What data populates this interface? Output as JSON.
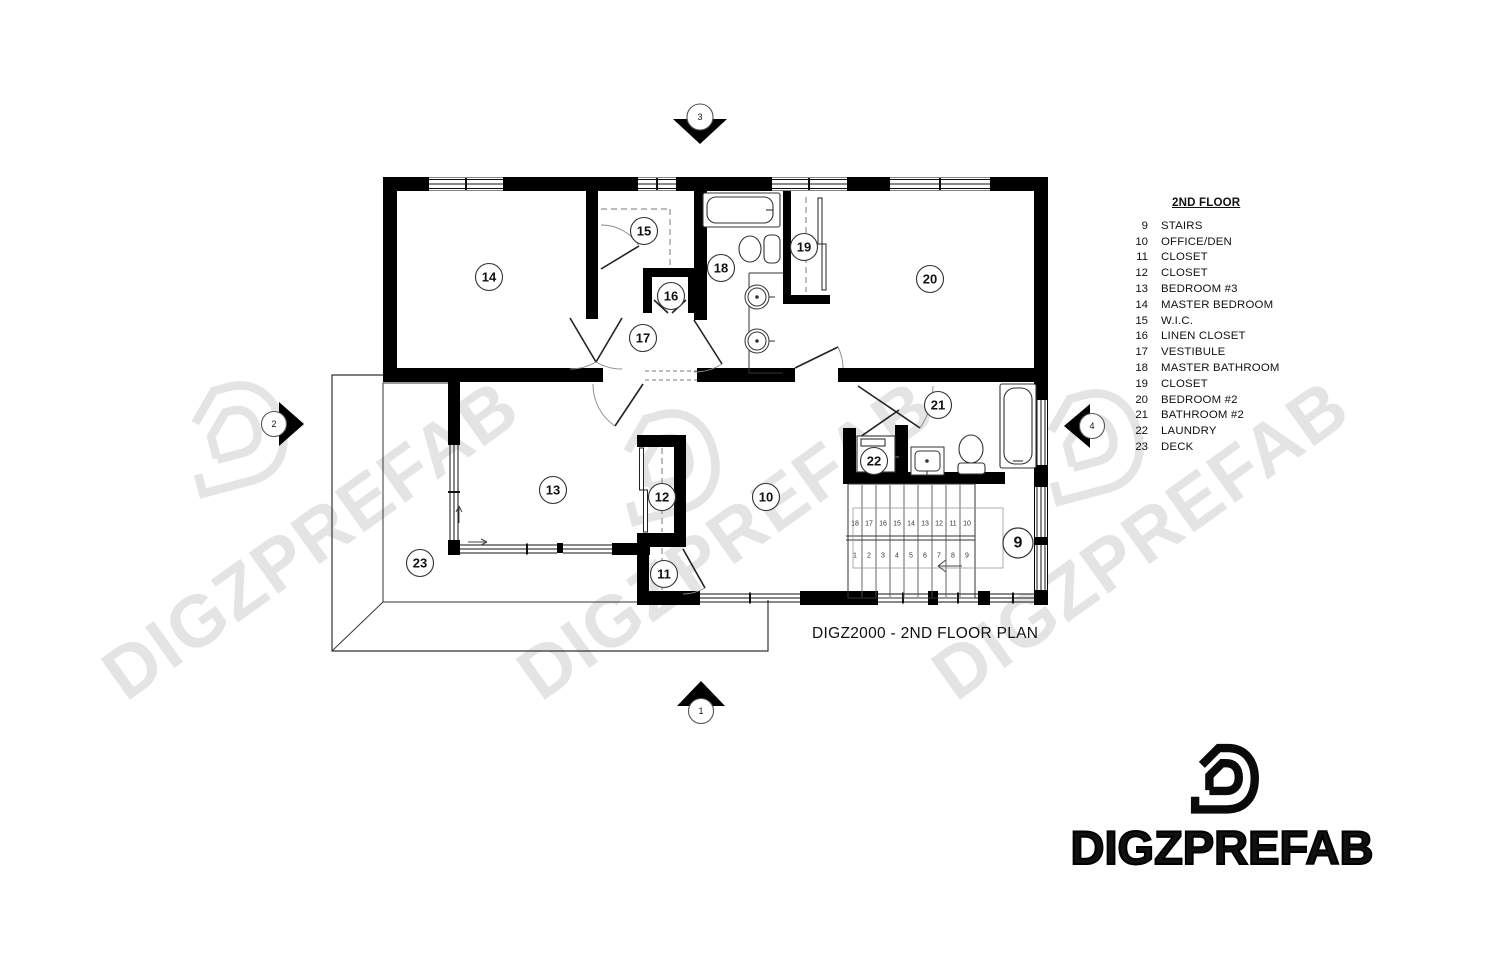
{
  "title": "DIGZ2000 - 2ND FLOOR PLAN",
  "legend": {
    "title": "2ND FLOOR",
    "items": [
      {
        "num": "9",
        "label": "STAIRS"
      },
      {
        "num": "10",
        "label": "OFFICE/DEN"
      },
      {
        "num": "11",
        "label": "CLOSET"
      },
      {
        "num": "12",
        "label": "CLOSET"
      },
      {
        "num": "13",
        "label": "BEDROOM #3"
      },
      {
        "num": "14",
        "label": "MASTER BEDROOM"
      },
      {
        "num": "15",
        "label": "W.I.C."
      },
      {
        "num": "16",
        "label": "LINEN CLOSET"
      },
      {
        "num": "17",
        "label": "VESTIBULE"
      },
      {
        "num": "18",
        "label": "MASTER BATHROOM"
      },
      {
        "num": "19",
        "label": "CLOSET"
      },
      {
        "num": "20",
        "label": "BEDROOM #2"
      },
      {
        "num": "21",
        "label": "BATHROOM #2"
      },
      {
        "num": "22",
        "label": "LAUNDRY"
      },
      {
        "num": "23",
        "label": "DECK"
      }
    ]
  },
  "plan": {
    "room_labels": [
      "14",
      "15",
      "16",
      "17",
      "18",
      "19",
      "20",
      "21",
      "22",
      "13",
      "12",
      "11",
      "10",
      "23",
      "9"
    ],
    "section_markers": {
      "top": "3",
      "left": "2",
      "right": "4",
      "bottom": "1"
    },
    "stairs": {
      "upper_run": [
        "18",
        "17",
        "16",
        "15",
        "14",
        "13",
        "12",
        "11",
        "10"
      ],
      "lower_run": [
        "1",
        "2",
        "3",
        "4",
        "5",
        "6",
        "7",
        "8",
        "9"
      ]
    }
  },
  "watermark": {
    "text": "DIGZPREFAB"
  },
  "logo": {
    "text": "DIGZPREFAB"
  },
  "colors": {
    "wall": "#000000",
    "line": "#2a2a2a",
    "watermark": "#e4e4e4",
    "paper": "#ffffff"
  }
}
